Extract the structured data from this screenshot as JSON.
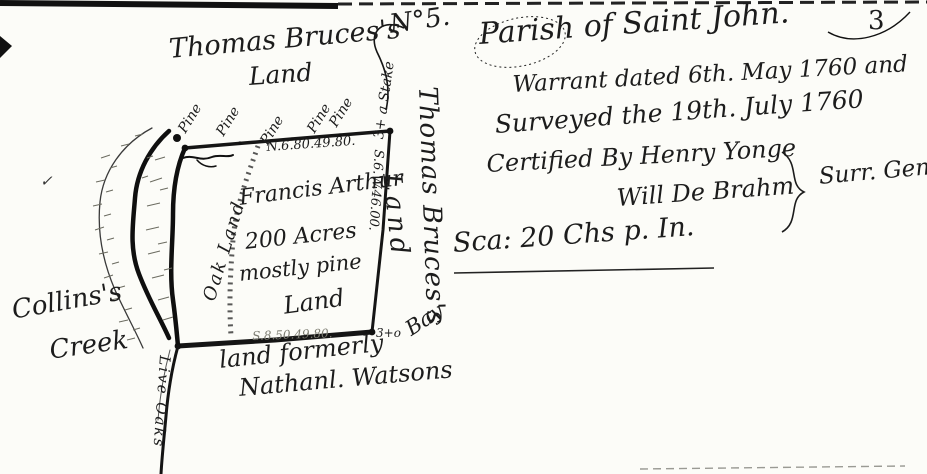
{
  "page": {
    "number": "3"
  },
  "plat": {
    "number": "N°5.",
    "north_owner_line1": "Thomas Bruces's",
    "north_owner_line2": "Land",
    "trees": [
      "Pine",
      "Pine",
      "Pine",
      "Pine",
      "Pine"
    ],
    "corner_ne_label": "3+ a Stake",
    "north_bearing": "N.6.80.49.80.",
    "east_bearing": "S.6.W.46.00.",
    "south_bearing": "S.8.50.49.80.",
    "owner_name": "Francis Arthur",
    "acreage": "200 Acres",
    "description_line1": "mostly pine",
    "description_line2": "Land",
    "west_label": "Oak Land",
    "east_owner_line1": "Thomas Bruces's",
    "east_owner_line2": "Land",
    "corner_se_mark": "3+o",
    "corner_se_tree": "Bay",
    "corner_sw_trees": "Live Oaks",
    "south_owner_line1": "land formerly",
    "south_owner_line2": "Nathanl. Watsons",
    "creek_name_line1": "Collins's",
    "creek_name_line2": "Creek",
    "check_mark": "✓"
  },
  "certificate": {
    "parish_line": "Parish of Saint John.",
    "warrant_line": "Warrant dated 6th. May 1760 and",
    "survey_line": "Surveyed the 19th. July 1760",
    "certified_line": "Certified By Henry Yonge",
    "deputy_line": "Will De Brahm",
    "surveyor_title": "Surr. Genl.",
    "scale_line": "Sca: 20 Chs p. In."
  },
  "colors": {
    "ink": "#1c1c1c",
    "faint_ink": "#7d7d72",
    "paper": "#fcfcf8"
  }
}
